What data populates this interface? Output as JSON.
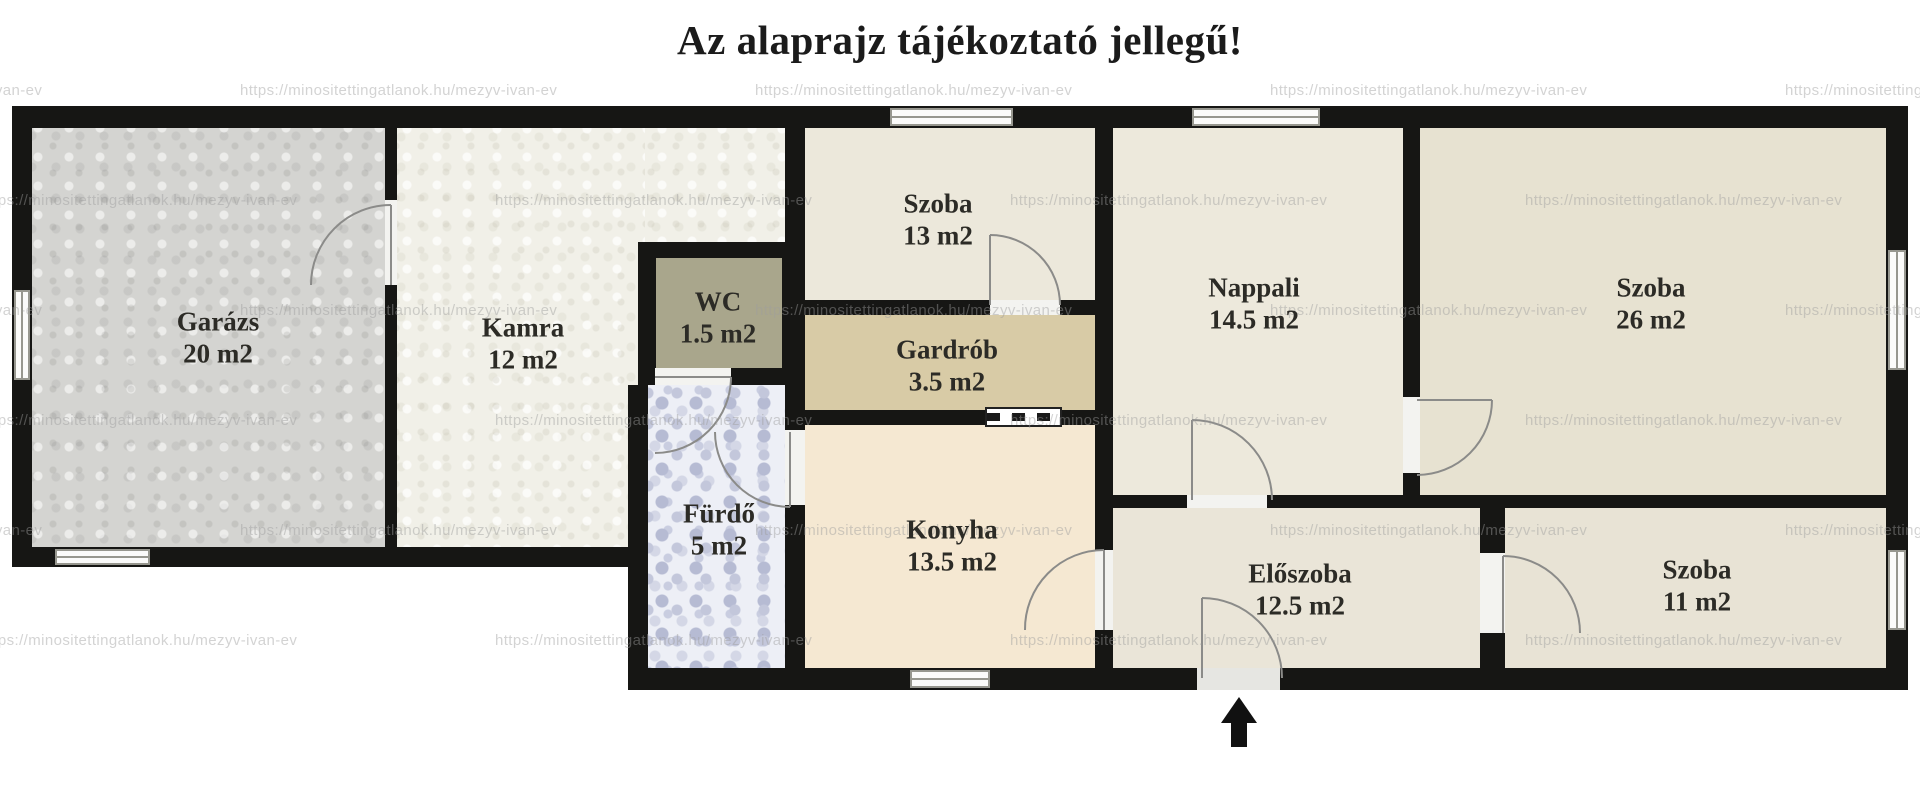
{
  "title": "Az alaprajz tájékoztató jellegű!",
  "watermark": {
    "text": "https://minositettingatlanok.hu/mezyv-ivan-ev"
  },
  "entrance": {
    "symbol": "up-arrow"
  },
  "colors": {
    "background": "#ffffff",
    "wall": "#161614",
    "title_text": "#1b1b1b",
    "label_text": "#2c2b26",
    "door_line": "#8b8b89",
    "window_frame": "#97978f"
  },
  "rooms": [
    {
      "id": "garazs",
      "name": "Garázs",
      "area": "20 m2",
      "color": "#d4d4d1"
    },
    {
      "id": "kamra",
      "name": "Kamra",
      "area": "12 m2",
      "color": "#f1f0e8"
    },
    {
      "id": "wc",
      "name": "WC",
      "area": "1.5 m2",
      "color": "#a9a68c"
    },
    {
      "id": "szoba13",
      "name": "Szoba",
      "area": "13 m2",
      "color": "#ece8db"
    },
    {
      "id": "gardrob",
      "name": "Gardrób",
      "area": "3.5 m2",
      "color": "#d8cba6"
    },
    {
      "id": "furdo",
      "name": "Fürdő",
      "area": "5 m2",
      "color": "#edeff6"
    },
    {
      "id": "konyha",
      "name": "Konyha",
      "area": "13.5 m2",
      "color": "#f5e8d2"
    },
    {
      "id": "nappali",
      "name": "Nappali",
      "area": "14.5 m2",
      "color": "#ede9dc"
    },
    {
      "id": "szoba26",
      "name": "Szoba",
      "area": "26 m2",
      "color": "#e7e2d1"
    },
    {
      "id": "eloszoba",
      "name": "Előszoba",
      "area": "12.5 m2",
      "color": "#eae5d8"
    },
    {
      "id": "szoba11",
      "name": "Szoba",
      "area": "11 m2",
      "color": "#e8e3d5"
    }
  ]
}
